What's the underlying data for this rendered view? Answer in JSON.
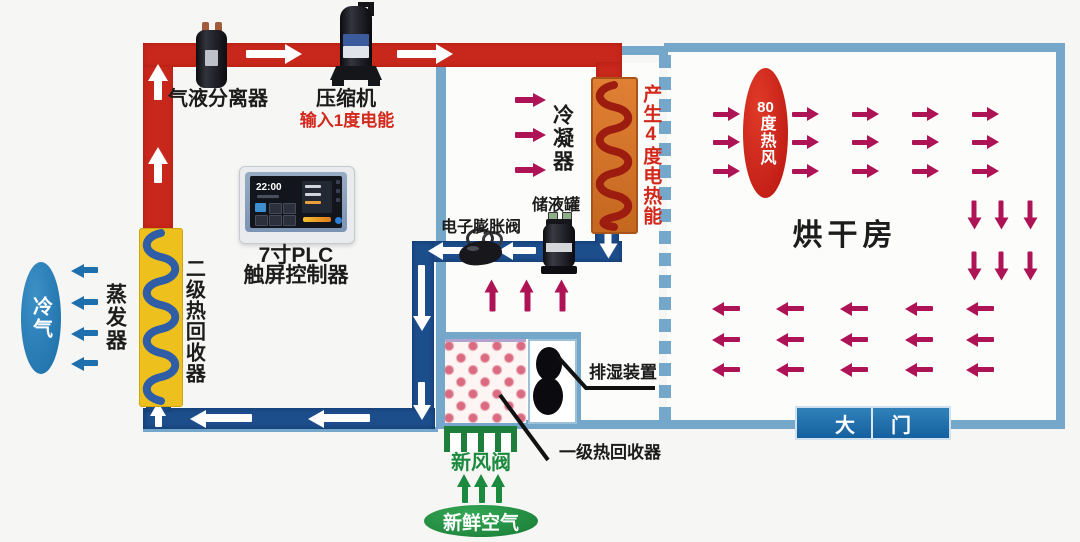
{
  "labels": {
    "separator": "气液分离器",
    "compressor": "压缩机",
    "power_input": "输入1度电能",
    "plc_line1": "7寸PLC",
    "plc_line2": "触屏控制器",
    "plc_time": "22:00",
    "condenser": "冷凝器",
    "heat_output": "产生4度电热能",
    "receiver": "储液罐",
    "expansion_valve": "电子膨胀阀",
    "evaporator": "蒸发器",
    "secondary_recovery": "二级热回收器",
    "cold_air": "冷气",
    "hot_air_num": "80",
    "hot_air_text": "度热风",
    "drying_room": "烘干房",
    "door": "大门",
    "dehumidifier": "排湿装置",
    "primary_recovery": "一级热回收器",
    "fresh_air_valve": "新风阀",
    "fresh_air": "新鲜空气"
  },
  "colors": {
    "red_pipe": "#c8281b",
    "blue_pipe": "#1d4e8c",
    "wall_blue": "#74a7ca",
    "crimson": "#ae1356",
    "green": "#1c8a3e",
    "red_accent": "#d3281c",
    "yellow_box": "#eec01e",
    "orange_box": "#d9762b",
    "door_blue": "#15609f",
    "cold_ellipse": "#1f7ab5",
    "hot_ellipse": "#cb1d15",
    "fresh_ellipse": "#259143"
  },
  "flow_arrows": [
    {
      "name": "red-riser-flow",
      "color": "#ffffff",
      "dir": "up",
      "len": 36,
      "th": 8,
      "hw": 17,
      "hh": 20,
      "pts": [
        [
          158,
          82
        ],
        [
          158,
          165
        ]
      ]
    },
    {
      "name": "red-top-flow",
      "color": "#ffffff",
      "dir": "right",
      "len": 56,
      "th": 8,
      "hw": 17,
      "hh": 20,
      "pts": [
        [
          274,
          54
        ],
        [
          425,
          54
        ]
      ]
    },
    {
      "name": "condenser-outlet-flow",
      "color": "#ffffff",
      "dir": "down",
      "len": 25,
      "th": 7,
      "hw": 15,
      "hh": 18,
      "pts": [
        [
          608,
          246
        ]
      ]
    },
    {
      "name": "liquid-line-flow",
      "color": "#ffffff",
      "dir": "left",
      "len": 38,
      "th": 7,
      "hw": 15,
      "hh": 18,
      "pts": [
        [
          447,
          251
        ],
        [
          517,
          251
        ]
      ]
    },
    {
      "name": "downcomer-flow",
      "color": "#ffffff",
      "dir": "down",
      "len": 66,
      "th": 7,
      "hw": 15,
      "hh": 18,
      "pts": [
        [
          422,
          298
        ]
      ]
    },
    {
      "name": "downcomer-flow-2",
      "color": "#ffffff",
      "dir": "down",
      "len": 38,
      "th": 7,
      "hw": 15,
      "hh": 18,
      "pts": [
        [
          422,
          401
        ]
      ]
    },
    {
      "name": "bottom-line-flow",
      "color": "#ffffff",
      "dir": "left",
      "len": 62,
      "th": 8,
      "hw": 16,
      "hh": 19,
      "pts": [
        [
          221,
          418
        ],
        [
          339,
          418
        ]
      ]
    },
    {
      "name": "recovery-inlet-flow",
      "color": "#ffffff",
      "dir": "up",
      "len": 25,
      "th": 7,
      "hw": 14,
      "hh": 17,
      "pts": [
        [
          158,
          414
        ]
      ]
    },
    {
      "name": "condenser-air-flow",
      "color": "#ae1356",
      "dir": "right",
      "len": 31,
      "th": 6,
      "hw": 13,
      "hh": 15,
      "pts": [
        [
          530,
          100
        ],
        [
          530,
          135
        ],
        [
          530,
          170
        ]
      ]
    },
    {
      "name": "recovered-air-flow",
      "color": "#ae1356",
      "dir": "up",
      "len": 32,
      "th": 6,
      "hw": 13,
      "hh": 15,
      "pts": [
        [
          492,
          295
        ],
        [
          527,
          295
        ],
        [
          562,
          295
        ]
      ]
    },
    {
      "name": "hot-air-flow",
      "color": "#ae1356",
      "dir": "right",
      "len": 27,
      "th": 5,
      "hw": 12,
      "hh": 14,
      "pts": [
        [
          726,
          114
        ],
        [
          726,
          142
        ],
        [
          726,
          171
        ],
        [
          805,
          114
        ],
        [
          805,
          142
        ],
        [
          805,
          171
        ],
        [
          865,
          114
        ],
        [
          865,
          142
        ],
        [
          865,
          171
        ],
        [
          925,
          114
        ],
        [
          925,
          142
        ],
        [
          925,
          171
        ],
        [
          985,
          114
        ],
        [
          985,
          142
        ],
        [
          985,
          171
        ]
      ]
    },
    {
      "name": "hot-air-down-flow",
      "color": "#ae1356",
      "dir": "down",
      "len": 29,
      "th": 5,
      "hw": 12,
      "hh": 14,
      "pts": [
        [
          974,
          215
        ],
        [
          1001,
          215
        ],
        [
          1030,
          215
        ],
        [
          974,
          266
        ],
        [
          1001,
          266
        ],
        [
          1030,
          266
        ]
      ]
    },
    {
      "name": "return-air-flow",
      "color": "#ae1356",
      "dir": "left",
      "len": 28,
      "th": 5,
      "hw": 12,
      "hh": 14,
      "pts": [
        [
          726,
          309
        ],
        [
          790,
          309
        ],
        [
          854,
          309
        ],
        [
          919,
          309
        ],
        [
          980,
          309
        ],
        [
          726,
          340
        ],
        [
          790,
          340
        ],
        [
          854,
          340
        ],
        [
          919,
          340
        ],
        [
          980,
          340
        ],
        [
          726,
          370
        ],
        [
          790,
          370
        ],
        [
          854,
          370
        ],
        [
          919,
          370
        ],
        [
          980,
          370
        ]
      ]
    },
    {
      "name": "cold-air-flow",
      "color": "#1d6fad",
      "dir": "left",
      "len": 27,
      "th": 6,
      "hw": 13,
      "hh": 15,
      "pts": [
        [
          84,
          270
        ],
        [
          84,
          302
        ],
        [
          84,
          333
        ],
        [
          84,
          363
        ]
      ]
    },
    {
      "name": "fresh-air-flow",
      "color": "#1c8a3e",
      "dir": "up",
      "len": 29,
      "th": 6,
      "hw": 13,
      "hh": 15,
      "pts": [
        [
          464,
          488
        ],
        [
          481,
          488
        ],
        [
          498,
          488
        ]
      ]
    }
  ]
}
